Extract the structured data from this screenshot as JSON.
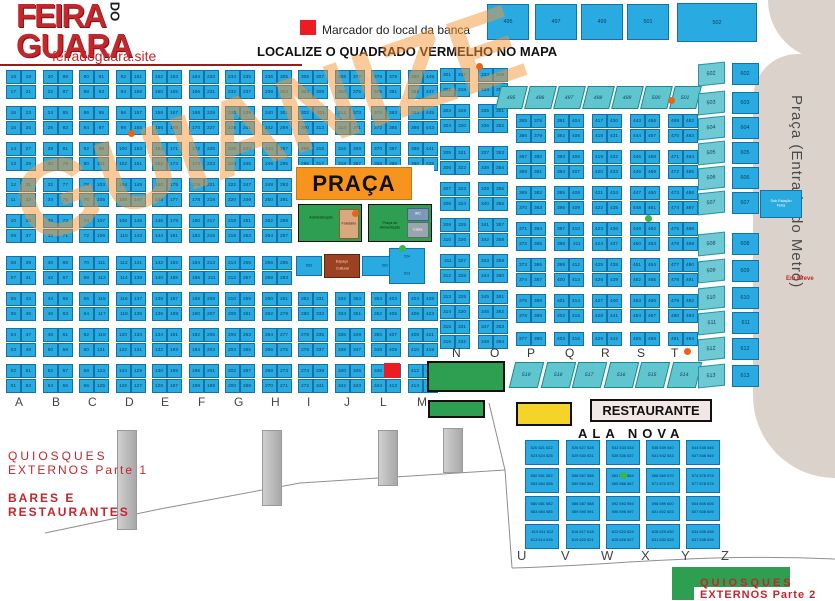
{
  "branding": {
    "logo_line1": "FEIRA",
    "logo_do": "DO",
    "logo_line2": "GUARA",
    "site": "feiradoguara.site"
  },
  "legend": {
    "marker_label": "Marcador do local da banca",
    "title": "LOCALIZE O QUADRADO VERMELHO NO MAPA"
  },
  "watermark": "GUIANIZE",
  "colors": {
    "stall_blue": "#29ABE2",
    "teal": "#5FC6CF",
    "orange": "#F7941E",
    "green": "#2E9E50",
    "yellow": "#F4D428",
    "red": "#ED1C24",
    "brand_red": "#C1272D",
    "beige": "#DBD3CB"
  },
  "top_row": {
    "boxes": [
      "495",
      "497",
      "499",
      "501"
    ],
    "wide": "502"
  },
  "skew_top": [
    "495",
    "496",
    "497",
    "498",
    "499",
    "500",
    "501"
  ],
  "left_grid": {
    "columns": [
      {
        "letter": "A",
        "left": [
          "18",
          "17",
          "16",
          "15",
          "14",
          "13",
          "12",
          "11",
          "10",
          "09",
          "08",
          "07",
          "06",
          "05",
          "04",
          "03",
          "02",
          "01"
        ],
        "right": [
          "19",
          "21",
          "23",
          "25",
          "27",
          "29",
          "31",
          "33",
          "35",
          "37",
          "39",
          "41",
          "43",
          "45",
          "47",
          "49",
          "51",
          "53"
        ]
      },
      {
        "letter": "B",
        "left": [
          "20",
          "22",
          "24",
          "26",
          "28",
          "30",
          "32",
          "34",
          "36",
          "38",
          "40",
          "42",
          "44",
          "46",
          "48",
          "50",
          "52",
          "54"
        ],
        "right": [
          "89",
          "87",
          "85",
          "83",
          "81",
          "79",
          "77",
          "75",
          "73",
          "71",
          "69",
          "67",
          "65",
          "63",
          "61",
          "59",
          "57",
          "55"
        ]
      },
      {
        "letter": "C",
        "left": [
          "90",
          "88",
          "86",
          "84",
          "82",
          "80",
          "78",
          "76",
          "74",
          "72",
          "70",
          "68",
          "66",
          "64",
          "62",
          "60",
          "58",
          "56"
        ],
        "right": [
          "91",
          "93",
          "95",
          "97",
          "99",
          "101",
          "103",
          "105",
          "107",
          "109",
          "111",
          "113",
          "115",
          "117",
          "119",
          "121",
          "123",
          "125"
        ]
      },
      {
        "letter": "D",
        "left": [
          "92",
          "94",
          "96",
          "98",
          "100",
          "102",
          "104",
          "106",
          "108",
          "110",
          "112",
          "114",
          "116",
          "118",
          "120",
          "122",
          "124",
          "126"
        ],
        "right": [
          "161",
          "159",
          "157",
          "155",
          "153",
          "151",
          "149",
          "147",
          "145",
          "143",
          "141",
          "139",
          "137",
          "135",
          "133",
          "131",
          "129",
          "127"
        ]
      },
      {
        "letter": "E",
        "left": [
          "162",
          "160",
          "158",
          "156",
          "154",
          "152",
          "150",
          "148",
          "146",
          "144",
          "142",
          "140",
          "138",
          "136",
          "134",
          "132",
          "130",
          "128"
        ],
        "right": [
          "163",
          "165",
          "167",
          "169",
          "171",
          "173",
          "175",
          "177",
          "179",
          "181",
          "183",
          "185",
          "187",
          "189",
          "191",
          "193",
          "195",
          "197"
        ]
      },
      {
        "letter": "F",
        "left": [
          "164",
          "166",
          "168",
          "170",
          "172",
          "174",
          "176",
          "178",
          "180",
          "182",
          "184",
          "186",
          "188",
          "190",
          "192",
          "194",
          "196",
          "198"
        ],
        "right": [
          "233",
          "231",
          "229",
          "227",
          "225",
          "223",
          "221",
          "219",
          "217",
          "215",
          "213",
          "211",
          "209",
          "207",
          "205",
          "203",
          "201",
          "199"
        ]
      },
      {
        "letter": "G",
        "left": [
          "234",
          "232",
          "230",
          "228",
          "226",
          "224",
          "222",
          "220",
          "218",
          "216",
          "214",
          "212",
          "210",
          "208",
          "206",
          "204",
          "202",
          "200"
        ],
        "right": [
          "235",
          "237",
          "239",
          "241",
          "243",
          "245",
          "247",
          "249",
          "251",
          "253",
          "255",
          "257",
          "259",
          "261",
          "263",
          "265",
          "267",
          "269"
        ]
      },
      {
        "letter": "H",
        "left": [
          "236",
          "238",
          "240",
          "242",
          "244",
          "246",
          "248",
          "250",
          "252",
          "254",
          "256",
          "258",
          "260",
          "262",
          "264",
          "266",
          "268",
          "270"
        ],
        "right": [
          "305",
          "303",
          "301",
          "299",
          "297",
          "295",
          "293",
          "291",
          "289",
          "287",
          "285",
          "283",
          "281",
          "279",
          "277",
          "275",
          "273",
          "271"
        ]
      },
      {
        "letter": "I",
        "left": [
          "306",
          "304",
          "302",
          "300",
          "298",
          "296",
          "294",
          "292",
          "290",
          "288",
          "286",
          "284",
          "282",
          "280",
          "278",
          "276",
          "274",
          "272"
        ],
        "right": [
          "307",
          "309",
          "311",
          "313",
          "315",
          "317",
          "319",
          "321",
          "323",
          "325",
          "327",
          "329",
          "331",
          "333",
          "335",
          "337",
          "339",
          "341"
        ]
      },
      {
        "letter": "J",
        "left": [
          "308",
          "310",
          "312",
          "314",
          "316",
          "318",
          "320",
          "322",
          "324",
          "326",
          "328",
          "330",
          "332",
          "334",
          "336",
          "338",
          "340",
          "342"
        ],
        "right": [
          "377",
          "375",
          "373",
          "371",
          "369",
          "367",
          "365",
          "363",
          "361",
          "359",
          "357",
          "355",
          "353",
          "351",
          "349",
          "347",
          "345",
          "343"
        ]
      },
      {
        "letter": "L",
        "left": [
          "378",
          "376",
          "374",
          "372",
          "370",
          "368",
          "366",
          "364",
          "362",
          "360",
          "358",
          "356",
          "354",
          "352",
          "350",
          "348",
          "346",
          "344"
        ],
        "right": [
          "379",
          "381",
          "383",
          "385",
          "387",
          "389",
          "391",
          "393",
          "395",
          "397",
          "399",
          "401",
          "403",
          "405",
          "407",
          "409",
          "411",
          "413"
        ]
      },
      {
        "letter": "M",
        "left": [
          "380",
          "382",
          "384",
          "386",
          "388",
          "390",
          "392",
          "394",
          "396",
          "398",
          "400",
          "402",
          "404",
          "406",
          "408",
          "410",
          "412",
          "414"
        ],
        "right": [
          "449",
          "447",
          "445",
          "443",
          "441",
          "439",
          "437",
          "435",
          "433",
          "431",
          "429",
          "427",
          "425",
          "423",
          "421",
          "419",
          "417",
          "415"
        ]
      }
    ]
  },
  "right_grid": {
    "columns": [
      {
        "left": [
          "301",
          "302",
          "303",
          "304",
          "305",
          "306",
          "307",
          "308",
          "309",
          "310",
          "311",
          "312",
          "313",
          "314",
          "315",
          "316"
        ],
        "right": [
          "317",
          "318",
          "319",
          "320",
          "321",
          "322",
          "323",
          "324",
          "325",
          "326",
          "327",
          "328",
          "329",
          "330",
          "331",
          "332"
        ]
      },
      {
        "left": [
          "333",
          "334",
          "335",
          "336",
          "337",
          "338",
          "339",
          "340",
          "341",
          "342",
          "343",
          "344",
          "345",
          "346",
          "347",
          "348"
        ],
        "right": [
          "349",
          "350",
          "351",
          "352",
          "353",
          "354",
          "355",
          "356",
          "357",
          "358",
          "359",
          "360",
          "361",
          "362",
          "363",
          "364"
        ]
      },
      {
        "left": [
          "365",
          "366",
          "367",
          "368",
          "369",
          "370",
          "371",
          "372",
          "373",
          "374",
          "375",
          "376",
          "377"
        ],
        "right": [
          "378",
          "379",
          "380",
          "381",
          "382",
          "383",
          "384",
          "385",
          "386",
          "387",
          "388",
          "389",
          "390"
        ]
      },
      {
        "left": [
          "391",
          "392",
          "393",
          "394",
          "395",
          "396",
          "397",
          "398",
          "399",
          "400",
          "401",
          "402",
          "403"
        ],
        "right": [
          "404",
          "405",
          "406",
          "407",
          "408",
          "409",
          "410",
          "411",
          "412",
          "413",
          "414",
          "415",
          "416"
        ]
      },
      {
        "left": [
          "417",
          "418",
          "419",
          "420",
          "421",
          "422",
          "423",
          "424",
          "425",
          "426",
          "427",
          "428",
          "429"
        ],
        "right": [
          "430",
          "431",
          "432",
          "433",
          "434",
          "435",
          "436",
          "437",
          "438",
          "439",
          "440",
          "441",
          "442"
        ]
      },
      {
        "left": [
          "443",
          "444",
          "445",
          "446",
          "447",
          "448",
          "449",
          "450",
          "451",
          "452",
          "453",
          "454",
          "455"
        ],
        "right": [
          "456",
          "457",
          "458",
          "459",
          "460",
          "461",
          "462",
          "463",
          "464",
          "465",
          "466",
          "467",
          "468"
        ]
      },
      {
        "left": [
          "469",
          "470",
          "471",
          "472",
          "473",
          "474",
          "475",
          "476",
          "477",
          "478",
          "479",
          "480",
          "481"
        ],
        "right": [
          "482",
          "483",
          "484",
          "485",
          "486",
          "487",
          "488",
          "489",
          "490",
          "491",
          "492",
          "493",
          "494"
        ]
      }
    ]
  },
  "praca": {
    "title": "PRAÇA",
    "green_left_label": "Administração",
    "tan_label": "Fraldário",
    "green_right_label": "Praça de Alimentação",
    "slate1": "WC",
    "slate2": "Caixa",
    "box1": "583",
    "brown_line1": "Espaço",
    "brown_line2": "Cultural",
    "box2": "562",
    "box3_line1": "524",
    "box3_line2": "523"
  },
  "skew_nt": {
    "letters": [
      "N",
      "O",
      "P",
      "Q",
      "R",
      "S",
      "T"
    ],
    "cells": [
      "519",
      "518",
      "517",
      "516",
      "515",
      "514"
    ]
  },
  "right_columns": {
    "inner": [
      "502",
      "503",
      "504",
      "505",
      "506",
      "507",
      "508",
      "509",
      "510",
      "511",
      "512",
      "513"
    ],
    "outer": [
      "602",
      "603",
      "604",
      "605",
      "606",
      "607",
      "608",
      "609",
      "610",
      "611",
      "612",
      "613"
    ],
    "substation": "Sub Estação Feira",
    "em_breve": "Em Breve"
  },
  "metro": {
    "label": "Praça (Entrada do Metrô)",
    "em_breve": "Em Breve"
  },
  "south": {
    "restaurante": "RESTAURANTE",
    "ala_nova": "ALA NOVA",
    "letters": [
      "U",
      "V",
      "W",
      "X",
      "Y",
      "Z"
    ],
    "boxes": [
      [
        "520 521 522",
        "523 524 525"
      ],
      [
        "526 527 528",
        "529 530 531"
      ],
      [
        "532 533 534",
        "535 536 537"
      ],
      [
        "538 539 540",
        "541 542 543"
      ],
      [
        "544 545 546",
        "547 548 549"
      ],
      [
        "550 551 552",
        "553 554 555"
      ],
      [
        "556 557 558",
        "559 560 561"
      ],
      [
        "562 563 564",
        "565 566 567"
      ],
      [
        "568 569 570",
        "571 572 573"
      ],
      [
        "574 575 576",
        "577 578 579"
      ],
      [
        "580 581 582",
        "583 584 585"
      ],
      [
        "586 587 588",
        "589 590 591"
      ],
      [
        "592 593 594",
        "595 596 597"
      ],
      [
        "598 599 600",
        "601 602 603"
      ],
      [
        "604 605 606",
        "607 608 609"
      ],
      [
        "610 611 612",
        "613 614 615"
      ],
      [
        "616 617 618",
        "619 620 621"
      ],
      [
        "622 623 624",
        "625 626 627"
      ],
      [
        "628 629 630",
        "631 632 633"
      ],
      [
        "634 635 636",
        "637 638 639"
      ]
    ]
  },
  "footer": {
    "q1_line1": "QUIOSQUES",
    "q1_line2": "EXTERNOS Parte 1",
    "bares_line1": "BARES E",
    "bares_line2": "RESTAURANTES",
    "q2_line1": "QUIOSQUES",
    "q2_line2": "EXTERNOS Parte 2"
  }
}
